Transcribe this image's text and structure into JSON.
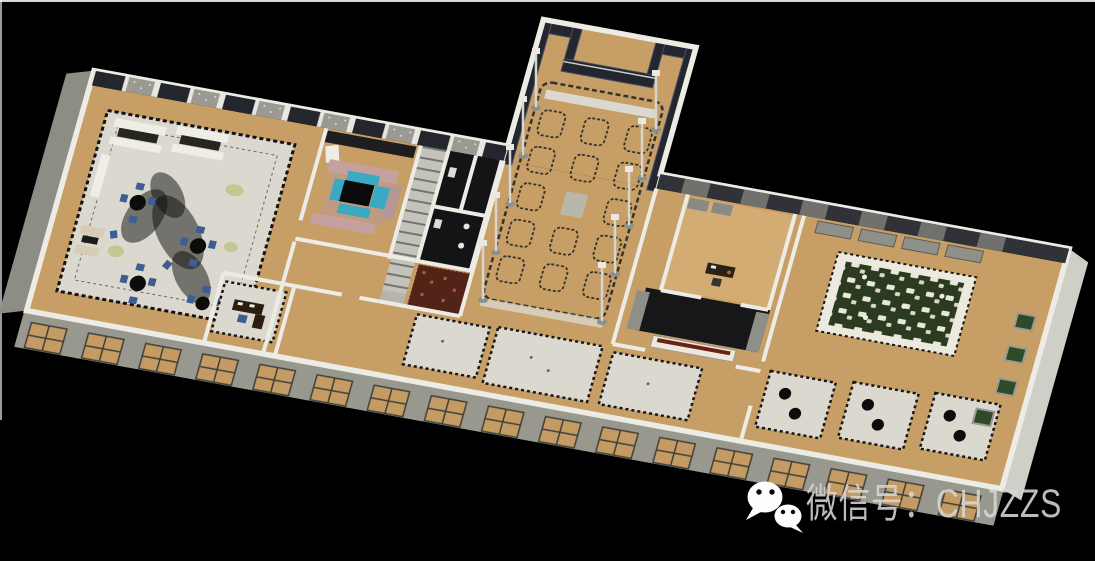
{
  "watermark": {
    "icon": "wechat-icon",
    "label": "微信号：CHJZZS",
    "text_color": "#d6d6d6"
  },
  "scene": {
    "type": "3d-axonometric-floorplan-render",
    "background": "#000000",
    "colors": {
      "bg": "#000000",
      "floor_wood": "#c79f66",
      "floor_wood_light": "#d2ac72",
      "wall_top": "#edece4",
      "wall_side": "#8d8d86",
      "carpet_light": "#dbd9cf",
      "carpet_red": "#532318",
      "lattice_dark": "#23262e",
      "buffet_green": "#2c3a20",
      "chair_blue": "#3c5e93",
      "seat_teal": "#3aa9c2",
      "sofa_pink": "#c4a09e",
      "room_dark": "#141417",
      "stair_gray": "#c2c2bb"
    }
  }
}
